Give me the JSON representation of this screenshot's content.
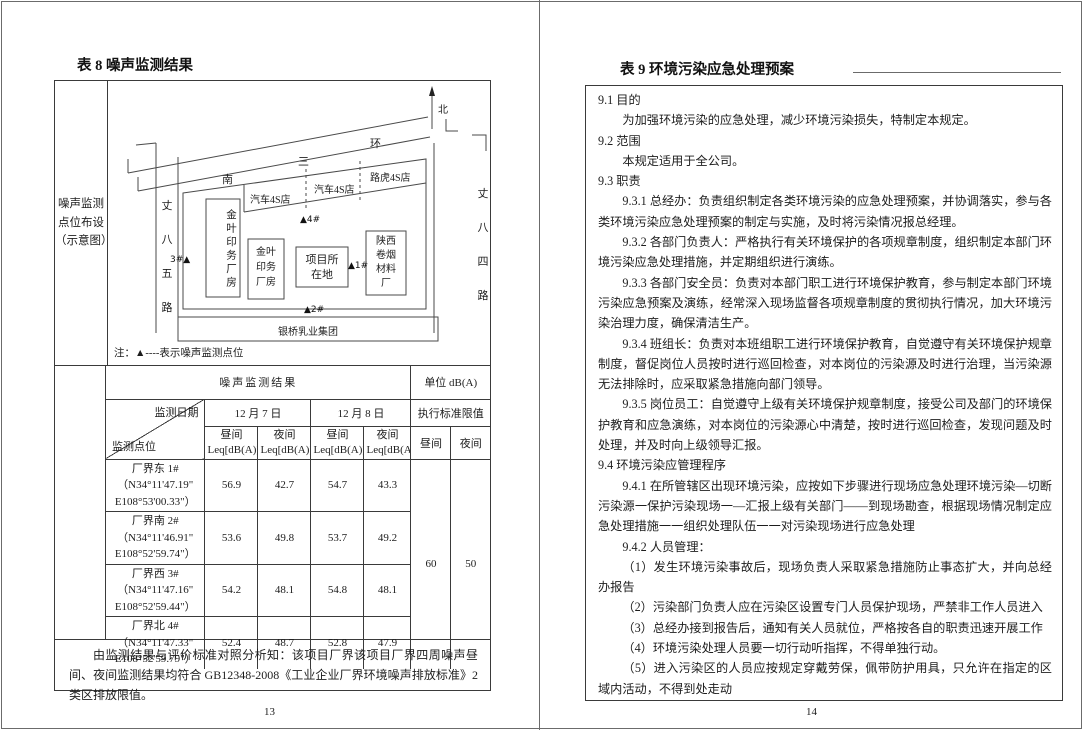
{
  "page_left": {
    "title": "表 8 噪声监测结果",
    "page_number": "13",
    "map_section": {
      "row_header": "噪声监测\n点位布设\n（示意图）",
      "north_label": "北",
      "ring_road_label": "南三环",
      "road_left": "丈八五路",
      "road_right": "丈八四路",
      "buildings": {
        "car4s_1": "汽车4S店",
        "car4s_2": "汽车4S店",
        "landrover": "路虎4S店",
        "jinye_tall": "金叶印务厂房",
        "jinye_small": "金叶印务厂房",
        "project": "项目所在地",
        "shaanxi_tobacco": "陕西卷烟材料厂",
        "dairy": "银桥乳业集团"
      },
      "markers": {
        "m4": "▲4#",
        "m3": "3#▲",
        "m1": "▲1#",
        "m2": "▲2#"
      },
      "note": "注：▲----表示噪声监测点位"
    },
    "noise_table": {
      "title": "噪声监测结果",
      "unit": "单位 dB(A)",
      "diag_top": "监测日期",
      "diag_bottom": "监测点位",
      "date1": "12 月 7 日",
      "date2": "12 月 8 日",
      "limit_header": "执行标准限值",
      "sub_day": "昼间\nLeq[dB(A)]",
      "sub_night": "夜间\nLeq[dB(A)]",
      "limit_day_label": "昼间",
      "limit_night_label": "夜间",
      "rows": [
        {
          "point": "厂界东 1#\n（N34°11'47.19\"\nE108°53'00.33\"）",
          "d7_day": "56.9",
          "d7_night": "42.7",
          "d8_day": "54.7",
          "d8_night": "43.3"
        },
        {
          "point": "厂界南 2#\n（N34°11'46.91\"\nE108°52'59.74\"）",
          "d7_day": "53.6",
          "d7_night": "49.8",
          "d8_day": "53.7",
          "d8_night": "49.2"
        },
        {
          "point": "厂界西 3#\n（N34°11'47.16\"\nE108°52'59.44\"）",
          "d7_day": "54.2",
          "d7_night": "48.1",
          "d8_day": "54.8",
          "d8_night": "48.1"
        },
        {
          "point": "厂界北 4#\n（N34°11'47.33\"\nE108°52'59.79\"）",
          "d7_day": "52.4",
          "d7_night": "48.7",
          "d8_day": "52.8",
          "d8_night": "47.9"
        }
      ],
      "limit_day": "60",
      "limit_night": "50"
    },
    "conclusion": "由监测结果与评价标准对照分析知：该项目厂界该项目厂界四周噪声昼间、夜间监测结果均符合 GB12348-2008《工业企业厂界环境噪声排放标准》2 类区排放限值。"
  },
  "page_right": {
    "title": "表 9 环境污染应急处理预案",
    "page_number": "14",
    "paragraphs": [
      "9.1 目的",
      "为加强环境污染的应急处理，减少环境污染损失，特制定本规定。",
      "9.2 范围",
      "本规定适用于全公司。",
      "9.3 职责",
      "9.3.1 总经办：负责组织制定各类环境污染的应急处理预案，并协调落实，参与各类环境污染应急处理预案的制定与实施，及时将污染情况报总经理。",
      "9.3.2 各部门负责人：严格执行有关环境保护的各项规章制度，组织制定本部门环境污染应急处理措施，并定期组织进行演练。",
      "9.3.3 各部门安全员：负责对本部门职工进行环境保护教育，参与制定本部门环境污染应急预案及演练，经常深入现场监督各项规章制度的贯彻执行情况，加大环境污染治理力度，确保清洁生产。",
      "9.3.4 班组长：负责对本班组职工进行环境保护教育，自觉遵守有关环境保护规章制度，督促岗位人员按时进行巡回检查，对本岗位的污染源及时进行治理，当污染源无法排除时，应采取紧急措施向部门领导。",
      "9.3.5 岗位员工：自觉遵守上级有关环境保护规章制度，接受公司及部门的环境保护教育和应急演练，对本岗位的污染源心中清楚，按时进行巡回检查，发现问题及时处理，并及时向上级领导汇报。",
      "9.4 环境污染应管理程序",
      "9.4.1 在所管辖区出现环境污染，应按如下步骤进行现场应急处理环境污染—切断污染源一保护污染现场一—汇报上级有关部门——到现场勘查，根据现场情况制定应急处理措施一一组织处理队伍一一对污染现场进行应急处理",
      "9.4.2 人员管理：",
      "（1）发生环境污染事故后，现场负责人采取紧急措施防止事态扩大，并向总经办报告",
      "（2）污染部门负责人应在污染区设置专门人员保护现场，严禁非工作人员进入",
      "（3）总经办接到报告后，通知有关人员就位，严格按各自的职责迅速开展工作",
      "（4）环境污染处理人员要一切行动听指挥，不得单独行动。",
      "（5）进入污染区的人员应按规定穿戴劳保，佩带防护用具，只允许在指定的区域内活动，不得到处走动",
      "（6）污染事故处理完毕，要做到工完料静场地清，安全监督部和事故单位应记录存档。"
    ]
  }
}
